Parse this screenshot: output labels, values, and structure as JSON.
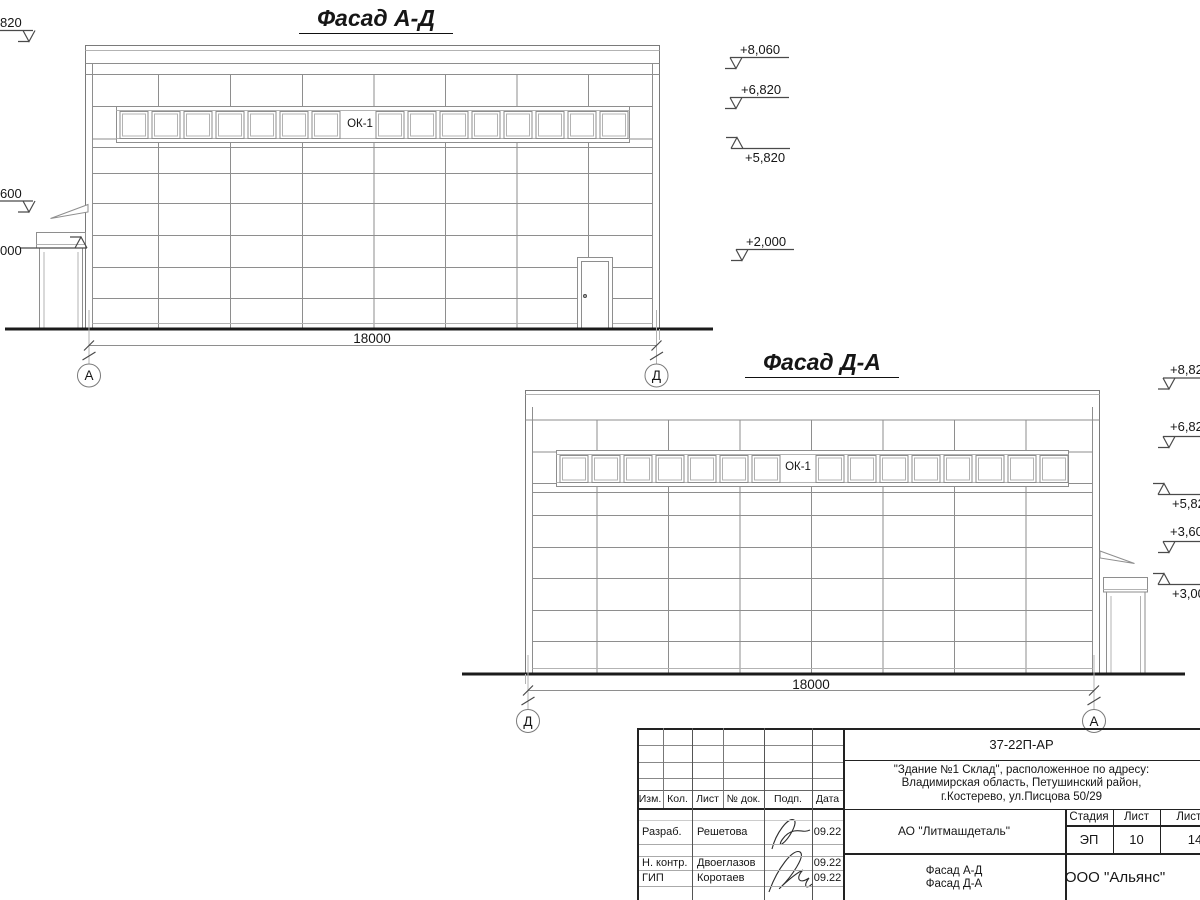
{
  "drawing": {
    "facade_ad": {
      "title": "Фасад А-Д",
      "window_label": "ОК-1",
      "dimension": "18000",
      "axis_left": "А",
      "axis_right": "Д",
      "elevation_marks_left": [
        "820",
        "600",
        "000"
      ],
      "elevation_marks_right": [
        "+8,060",
        "+6,820",
        "+5,820",
        "+2,000"
      ]
    },
    "facade_da": {
      "title": "Фасад Д-А",
      "window_label": "ОК-1",
      "dimension": "18000",
      "axis_left": "Д",
      "axis_right": "А",
      "elevation_marks_right": [
        "+8,820",
        "+6,820",
        "+5,820",
        "+3,600",
        "+3,000"
      ]
    }
  },
  "title_block": {
    "doc_number": "37-22П-АР",
    "project_lines": [
      "\"Здание №1 Склад\", расположенное по адресу:",
      "Владимирская область, Петушинский район,",
      "г.Костерево, ул.Писцова 50/29"
    ],
    "client": "АО \"Литмашдеталь\"",
    "revision_headers": [
      "Изм.",
      "Кол.",
      "Лист",
      "№ док.",
      "Подп.",
      "Дата"
    ],
    "signature_rows": [
      {
        "role": "Разраб.",
        "name": "Решетова",
        "date": "09.22"
      },
      {
        "role": "Н. контр.",
        "name": "Двоеглазов",
        "date": "09.22"
      },
      {
        "role": "ГИП",
        "name": "Коротаев",
        "date": "09.22"
      }
    ],
    "stage_label": "Стадия",
    "stage": "ЭП",
    "sheet_label": "Лист",
    "sheet": "10",
    "total_label": "Листов",
    "total": "14",
    "sheet_title_lines": [
      "Фасад А-Д",
      "Фасад Д-А"
    ],
    "company": "ООО \"Альянс\""
  }
}
